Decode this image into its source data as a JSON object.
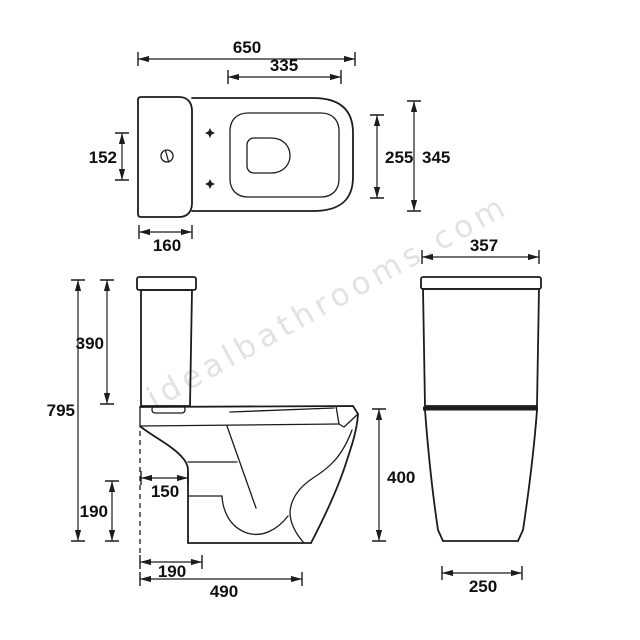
{
  "watermark": "idealbathrooms.com",
  "plan_view": {
    "overall_length": "650",
    "seat_cutout_length": "335",
    "flush_button_span": "152",
    "bowl_opening_width": "255",
    "pan_width": "345",
    "cistern_depth": "160"
  },
  "side_view": {
    "overall_height": "795",
    "cistern_height": "390",
    "pedestal_setback": "150",
    "pedestal_base_height": "190",
    "outlet_setback": "190",
    "overall_depth": "490"
  },
  "rear_view": {
    "cistern_width": "357",
    "pan_height": "400",
    "base_width": "250"
  },
  "colors": {
    "line": "#1c1c1c",
    "background": "#ffffff",
    "watermark": "#e2e2e2",
    "text": "#101010"
  }
}
